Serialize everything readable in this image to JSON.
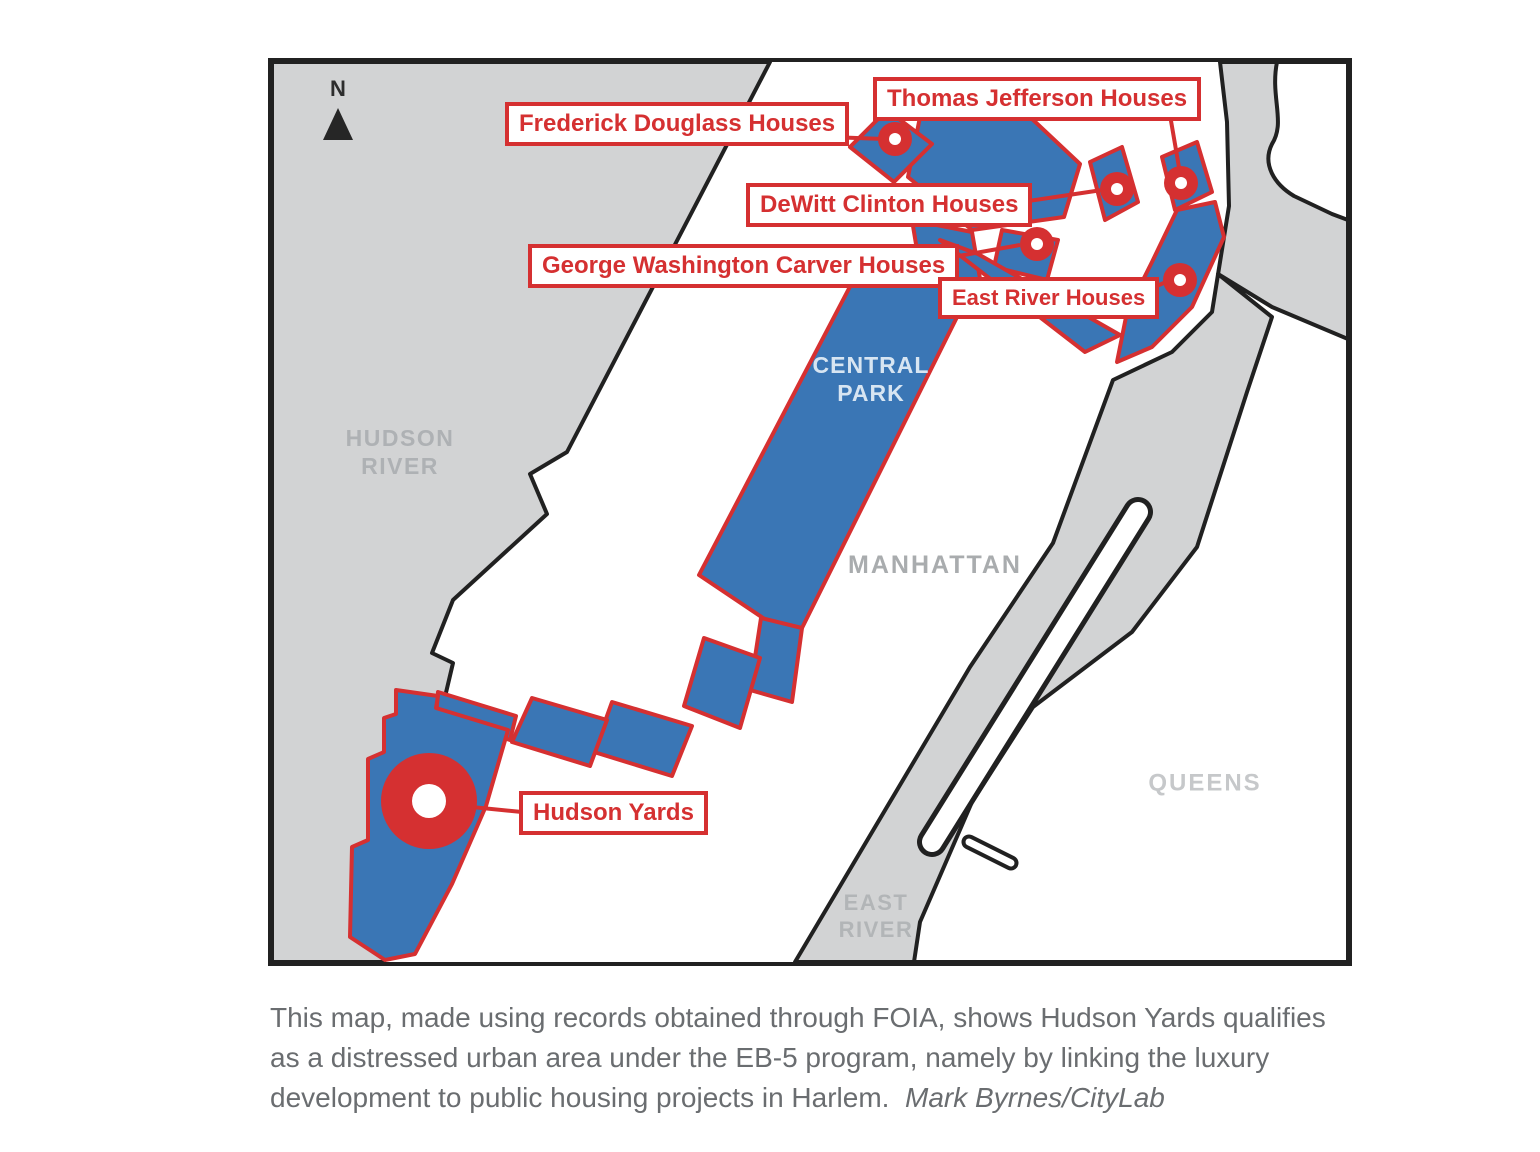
{
  "map": {
    "compass_label": "N",
    "area_labels": {
      "hudson_river": "HUDSON\nRIVER",
      "central_park": "CENTRAL\nPARK",
      "manhattan": "MANHATTAN",
      "queens": "QUEENS",
      "east_river": "EAST\nRIVER"
    },
    "callouts": [
      {
        "id": "frederick-douglass-houses",
        "label": "Frederick Douglass Houses"
      },
      {
        "id": "thomas-jefferson-houses",
        "label": "Thomas Jefferson Houses"
      },
      {
        "id": "dewitt-clinton-houses",
        "label": "DeWitt Clinton Houses"
      },
      {
        "id": "george-washington-carver-houses",
        "label": "George Washington Carver Houses"
      },
      {
        "id": "east-river-houses",
        "label": "East River Houses"
      },
      {
        "id": "hudson-yards",
        "label": "Hudson Yards"
      }
    ],
    "colors": {
      "tract_blue": "#3a76b5",
      "accent_red": "#d53031",
      "water_gray": "#d2d3d4",
      "shoreline_black": "#212121",
      "area_label_gray": "#aeb1b4"
    }
  },
  "caption": {
    "text": "This map, made using records obtained through FOIA, shows Hudson Yards qualifies as a distressed urban area under the EB-5 program, namely by linking the luxury development to public housing projects in Harlem.",
    "credit": "Mark Byrnes/CityLab"
  }
}
